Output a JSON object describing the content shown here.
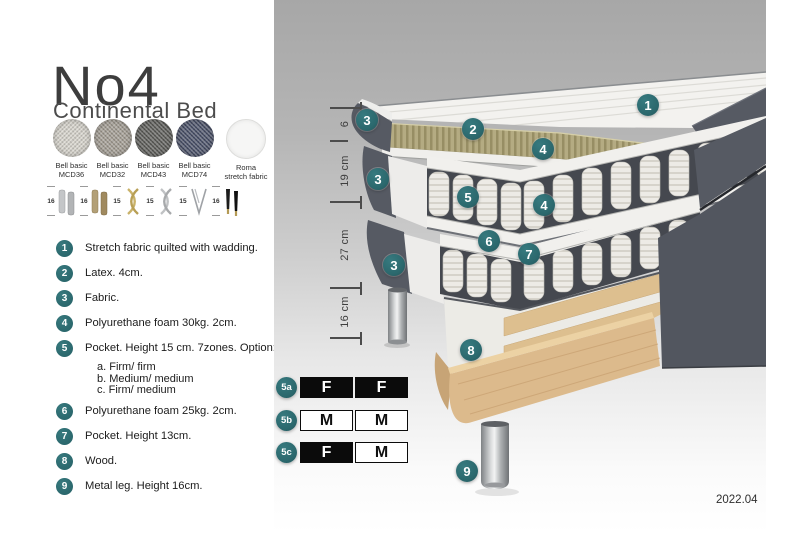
{
  "header": {
    "title": "No4",
    "subtitle": "Continental Bed"
  },
  "fabric_swatches": [
    {
      "line1": "Bell basic",
      "line2": "MCD36",
      "color": "#d7d4cc"
    },
    {
      "line1": "Bell basic",
      "line2": "MCD32",
      "color": "#a39d93"
    },
    {
      "line1": "Bell basic",
      "line2": "MCD43",
      "color": "#5d5d59"
    },
    {
      "line1": "Bell basic",
      "line2": "MCD74",
      "color": "#495068"
    },
    {
      "line1": "Roma",
      "line2": "stretch fabric",
      "color": "#f6f6f5"
    }
  ],
  "leg_options": [
    {
      "height_cm": "16",
      "style": "cylinder-silver"
    },
    {
      "height_cm": "16",
      "style": "cylinder-brass"
    },
    {
      "height_cm": "15",
      "style": "twisted-gold"
    },
    {
      "height_cm": "15",
      "style": "twisted-silver"
    },
    {
      "height_cm": "15",
      "style": "hairpin-metal"
    },
    {
      "height_cm": "16",
      "style": "tapered-black-gold"
    }
  ],
  "spec_list": [
    {
      "num": "1",
      "text": "Stretch fabric quilted with wadding."
    },
    {
      "num": "2",
      "text": "Latex. 4cm."
    },
    {
      "num": "3",
      "text": "Fabric."
    },
    {
      "num": "4",
      "text": "Polyurethane foam 30kg. 2cm."
    },
    {
      "num": "5",
      "text": "Pocket. Height 15 cm. 7zones. Option:",
      "options": [
        "a. Firm/ firm",
        "b. Medium/ medium",
        "c. Firm/ medium"
      ]
    },
    {
      "num": "6",
      "text": "Polyurethane foam 25kg. 2cm."
    },
    {
      "num": "7",
      "text": "Pocket. Height 13cm."
    },
    {
      "num": "8",
      "text": "Wood."
    },
    {
      "num": "9",
      "text": "Metal leg. Height 16cm."
    }
  ],
  "diagram": {
    "markers": [
      {
        "label": "1",
        "part": "stretch-fabric-top"
      },
      {
        "label": "2",
        "part": "latex-layer"
      },
      {
        "label": "3",
        "part": "fabric-top-pad"
      },
      {
        "label": "3",
        "part": "fabric-middle"
      },
      {
        "label": "3",
        "part": "fabric-base"
      },
      {
        "label": "4",
        "part": "foam-30kg-upper"
      },
      {
        "label": "4",
        "part": "foam-30kg-lower"
      },
      {
        "label": "5",
        "part": "pocket-springs-15cm"
      },
      {
        "label": "6",
        "part": "foam-25kg"
      },
      {
        "label": "7",
        "part": "pocket-springs-13cm"
      },
      {
        "label": "8",
        "part": "wood-frame"
      },
      {
        "label": "9",
        "part": "metal-leg"
      }
    ],
    "dimensions": [
      {
        "label": "6"
      },
      {
        "label": "19 cm"
      },
      {
        "label": "27 cm"
      },
      {
        "label": "16 cm"
      }
    ]
  },
  "firmness_table": {
    "rows": [
      {
        "id": "5a",
        "cells": [
          {
            "value": "F",
            "style": "filled"
          },
          {
            "value": "F",
            "style": "filled"
          }
        ]
      },
      {
        "id": "5b",
        "cells": [
          {
            "value": "M",
            "style": "outline"
          },
          {
            "value": "M",
            "style": "outline"
          }
        ]
      },
      {
        "id": "5c",
        "cells": [
          {
            "value": "F",
            "style": "filled"
          },
          {
            "value": "M",
            "style": "outline"
          }
        ]
      }
    ]
  },
  "meta": {
    "version": "2022.04"
  },
  "colors": {
    "accent_teal": "#2b686d",
    "fabric_dark": "#565a63",
    "latex": "#b4ab82",
    "wood": "#dcba8c",
    "table_black": "#0b0b0b"
  }
}
